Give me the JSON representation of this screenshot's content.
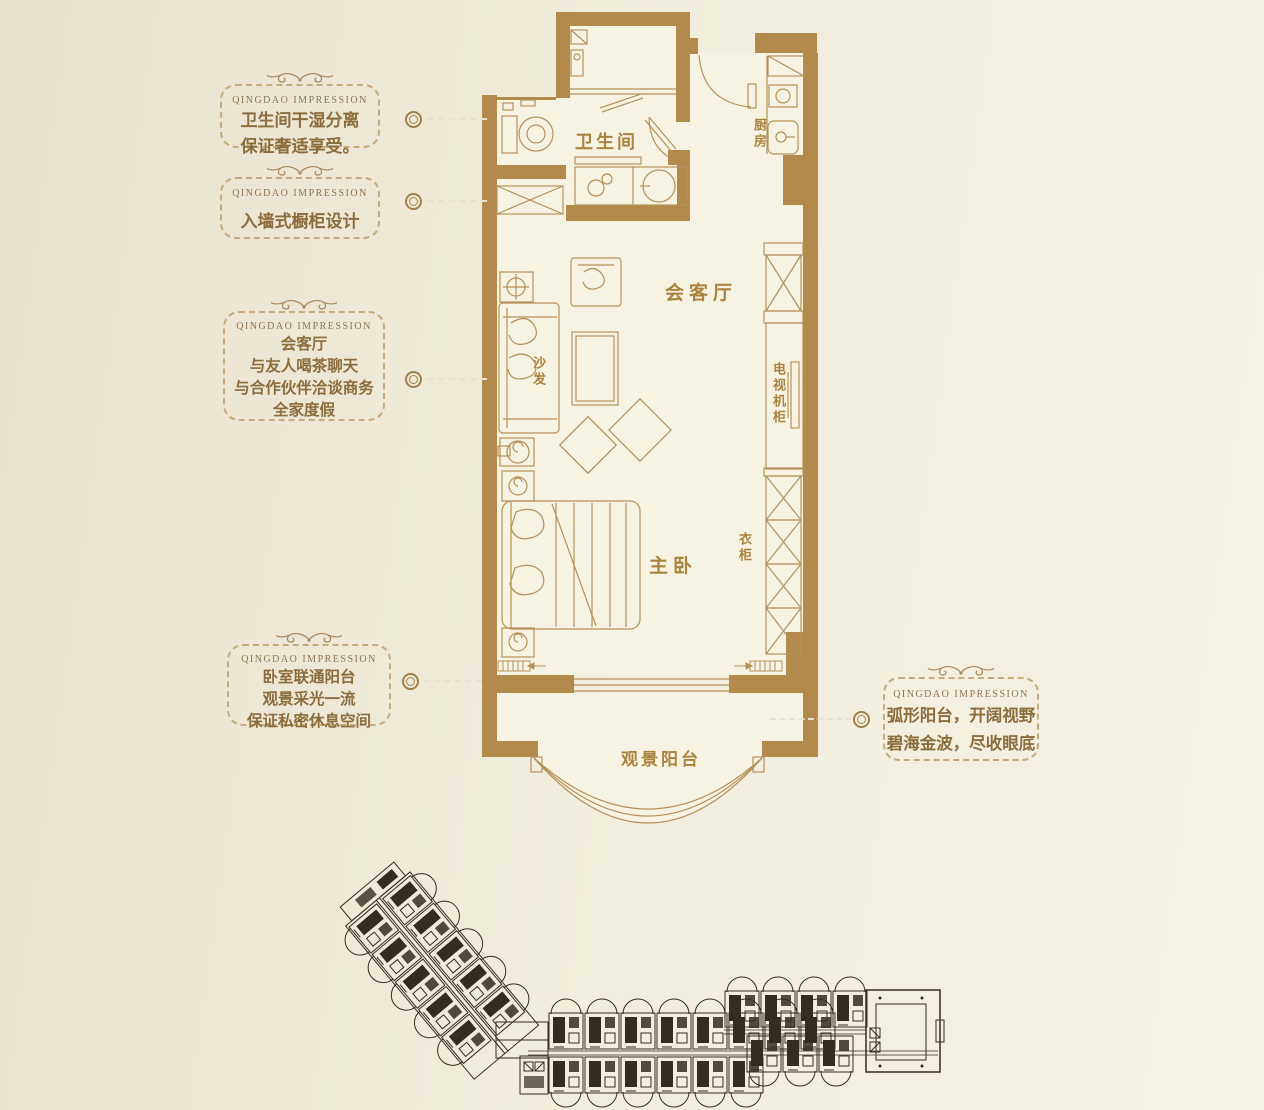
{
  "palette": {
    "background": "#f2eedd",
    "wall_gold": "#b28a4c",
    "furniture_line": "#b6905a",
    "label_gold": "#a9833f",
    "callout_text": "#8c6c3c",
    "callout_border": "#c6ab7c",
    "header_brown": "#8d7450",
    "site_plan_dark": "#342b21",
    "floor_fill": "#f7f3e2"
  },
  "callouts": [
    {
      "id": "bathroom",
      "header": "QINGDAO IMPRESSION",
      "lines": [
        "卫生间干湿分离",
        "保证奢适享受。"
      ]
    },
    {
      "id": "cabinet",
      "header": "QINGDAO IMPRESSION",
      "lines": [
        "入墙式橱柜设计"
      ]
    },
    {
      "id": "living",
      "header": "QINGDAO IMPRESSION",
      "lines": [
        "会客厅",
        "与友人喝茶聊天",
        "与合作伙伴洽谈商务",
        "全家度假"
      ]
    },
    {
      "id": "bedroom",
      "header": "QINGDAO IMPRESSION",
      "lines": [
        "卧室联通阳台",
        "观景采光一流",
        "保证私密休息空间"
      ]
    },
    {
      "id": "balcony",
      "header": "QINGDAO IMPRESSION",
      "lines": [
        "弧形阳台，开阔视野",
        "碧海金波，尽收眼底"
      ]
    }
  ],
  "plan_labels": {
    "bathroom": "卫生间",
    "kitchen": "厨房",
    "living": "会客厅",
    "sofa": "沙发",
    "tv_cabinet": "电视机柜",
    "bedroom": "主卧",
    "wardrobe": "衣柜",
    "balcony": "观景阳台"
  }
}
